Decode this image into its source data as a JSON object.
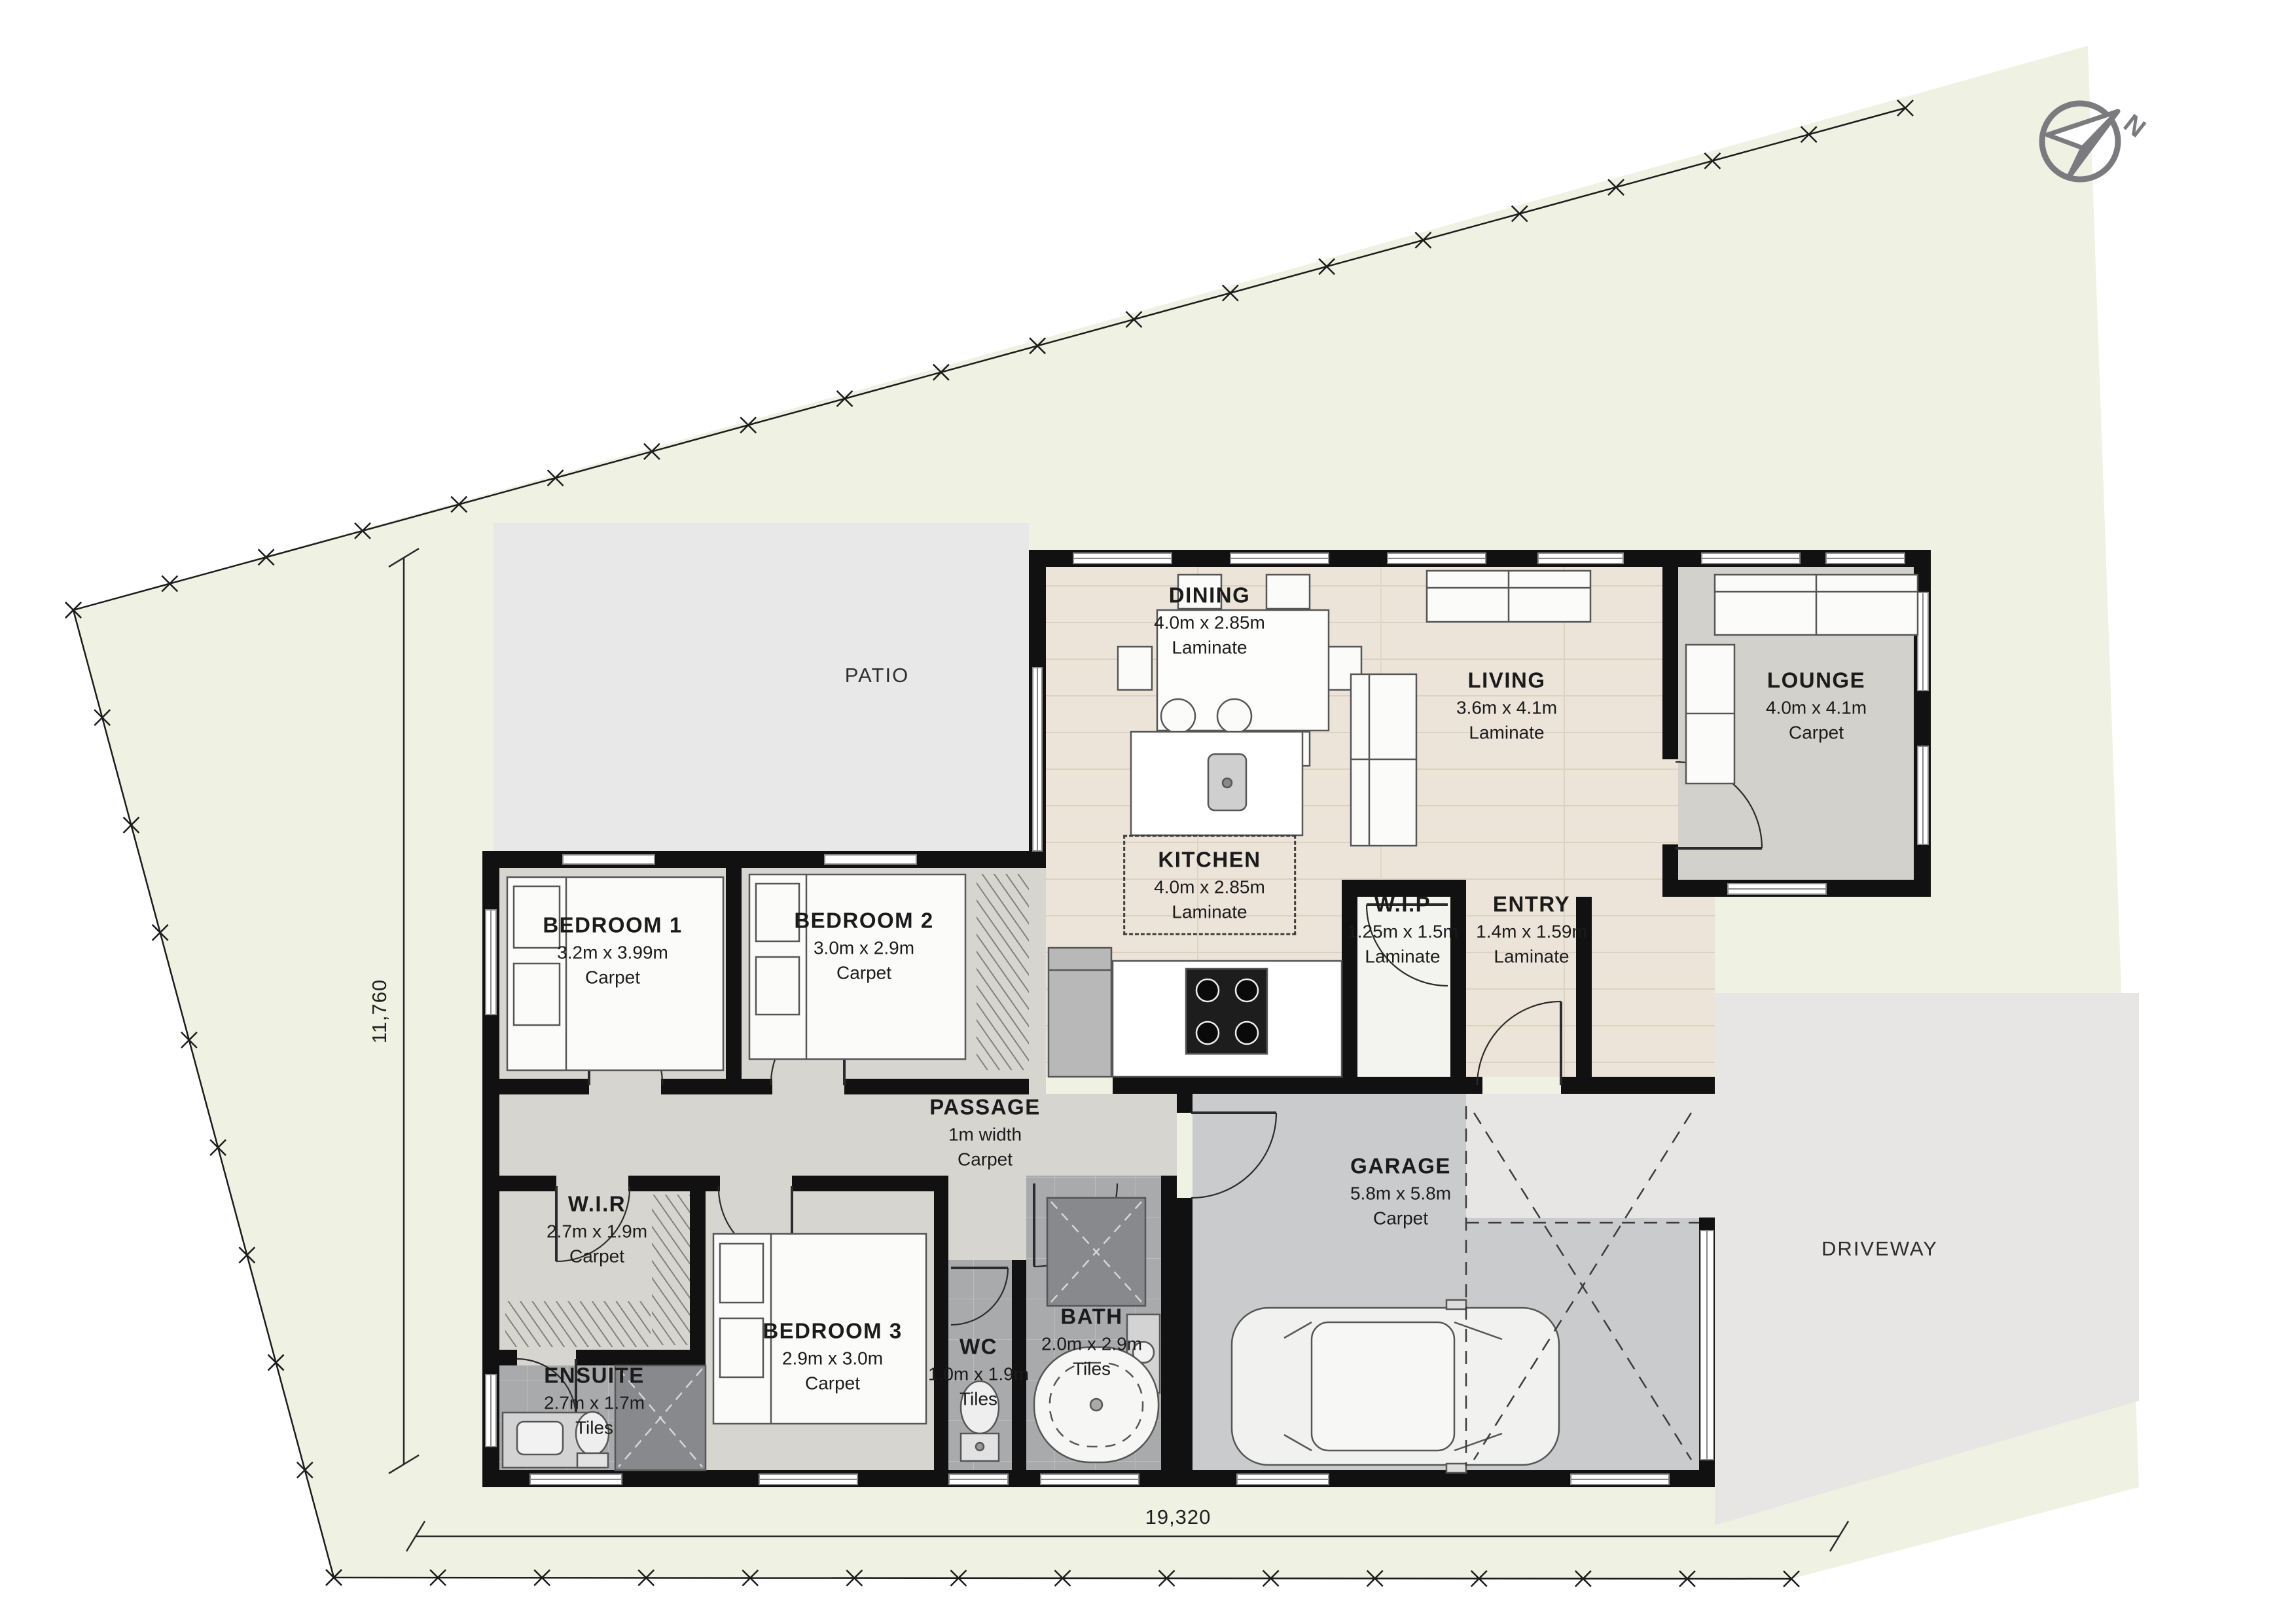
{
  "rooms": [
    {
      "name": "DINING",
      "size": "4.0m x 2.85m",
      "floor": "Laminate"
    },
    {
      "name": "LIVING",
      "size": "3.6m x 4.1m",
      "floor": "Laminate"
    },
    {
      "name": "LOUNGE",
      "size": "4.0m x 4.1m",
      "floor": "Carpet"
    },
    {
      "name": "KITCHEN",
      "size": "4.0m x 2.85m",
      "floor": "Laminate"
    },
    {
      "name": "W.I.P",
      "size": "1.25m x 1.5m",
      "floor": "Laminate"
    },
    {
      "name": "ENTRY",
      "size": "1.4m x 1.59m",
      "floor": "Laminate"
    },
    {
      "name": "BEDROOM 1",
      "size": "3.2m x 3.99m",
      "floor": "Carpet"
    },
    {
      "name": "BEDROOM 2",
      "size": "3.0m x 2.9m",
      "floor": "Carpet"
    },
    {
      "name": "PASSAGE",
      "size": "1m width",
      "floor": "Carpet"
    },
    {
      "name": "W.I.R",
      "size": "2.7m x 1.9m",
      "floor": "Carpet"
    },
    {
      "name": "ENSUITE",
      "size": "2.7m x 1.7m",
      "floor": "Tiles"
    },
    {
      "name": "BEDROOM 3",
      "size": "2.9m x 3.0m",
      "floor": "Carpet"
    },
    {
      "name": "WC",
      "size": "1.0m x 1.9m",
      "floor": "Tiles"
    },
    {
      "name": "BATH",
      "size": "2.0m x 2.9m",
      "floor": "Tiles"
    },
    {
      "name": "GARAGE",
      "size": "5.8m x 5.8m",
      "floor": "Carpet"
    }
  ],
  "areas": [
    {
      "label": "PATIO"
    },
    {
      "label": "DRIVEWAY"
    }
  ],
  "dimensions": {
    "bottom": "19,320",
    "left": "11,760"
  },
  "north": {
    "label": "N"
  },
  "colors": {
    "site": "#eff1e2",
    "patio": "#e9e8e8",
    "driveway": "#e8e6e5",
    "wood": "#ece4d8",
    "carpet": "#d7d5d0",
    "lounge_carpet": "#d3d1cc",
    "tiles": "#a9aaac",
    "garage": "#c9cbcd",
    "wip": "#f3f3f0",
    "wall": "#111111",
    "north_gray": "#7b7b7f"
  }
}
